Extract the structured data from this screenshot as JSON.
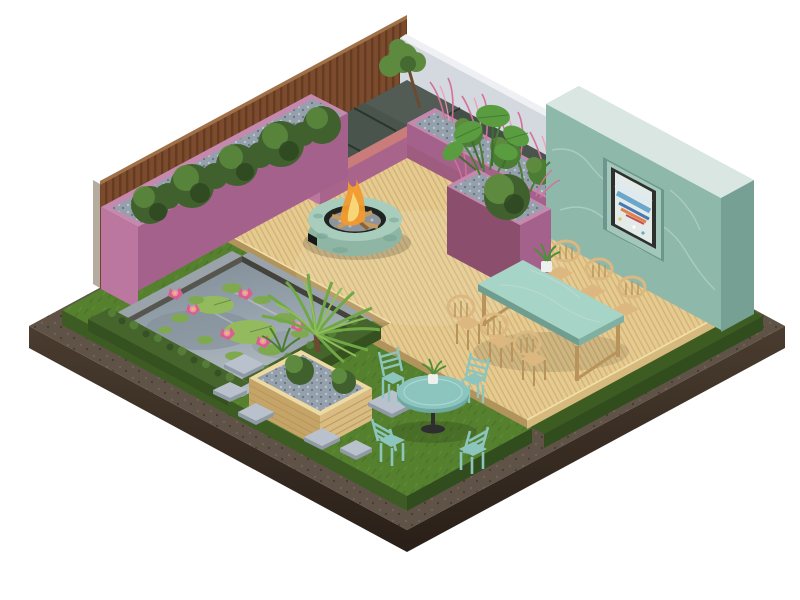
{
  "scene": {
    "title": "Isometric garden patio — 3D render",
    "width": 800,
    "height": 600,
    "background": "#ffffff"
  },
  "objects": [
    {
      "id": "timber-fence",
      "label": "Vertical timber slat fence"
    },
    {
      "id": "white-wall",
      "label": "White boundary wall"
    },
    {
      "id": "teal-marble-wall",
      "label": "Green marble feature wall with framed abstract painting"
    },
    {
      "id": "corner-bench",
      "label": "L-shaped bench with dark tiles and pink fascia"
    },
    {
      "id": "planter-long",
      "label": "Long pink planter with shrubs and gravel"
    },
    {
      "id": "planter-grasses",
      "label": "Back pink planter with pink fountain grasses"
    },
    {
      "id": "planter-tall",
      "label": "Tall pink planter with monstera, ferns and bush"
    },
    {
      "id": "deck",
      "label": "Timber slat deck patio"
    },
    {
      "id": "fire-pit",
      "label": "Round verdigris fire pit, lit with logs"
    },
    {
      "id": "pond",
      "label": "Reflecting pond with lily pads and pink water lilies"
    },
    {
      "id": "planter-timber",
      "label": "Timber slat planter with palm and bushes"
    },
    {
      "id": "dining-set",
      "label": "Green marble-top dining table with six timber chairs"
    },
    {
      "id": "bistro-set",
      "label": "Teal bistro table with four metal chairs on lawn"
    },
    {
      "id": "lawn",
      "label": "Lawn with stepping stones"
    },
    {
      "id": "soil-base",
      "label": "Dark soil base with gravel path border"
    }
  ],
  "palette": {
    "bg": "#ffffff",
    "soil_path": "#5f5347",
    "soil_speck_light": "#7b6b5c",
    "soil_speck_dark": "#382d23",
    "soil_side": "#4a3c2f",
    "soil_side_deep": "#291f18",
    "grass": "#55812f",
    "grass_light": "#69a03c",
    "grass_dark": "#3c5c22",
    "grass_side": "#3d5c23",
    "grass_side_dark": "#314d1e",
    "deck": "#e5cb90",
    "deck_line": "#c19b5e",
    "deck_side": "#d6b97c",
    "deck_side_dark": "#b1945c",
    "deck_lip": "#f2dfa8",
    "fence_wood": "#7c4a2c",
    "fence_line": "#5e3820",
    "fence_top": "#a07048",
    "fence_end": "#b5ac9f",
    "wall_white": "#d4d8df",
    "wall_white_top": "#eef0f4",
    "wall_teal": "#8db8aa",
    "wall_teal_top": "#d9e6e1",
    "wall_teal_side": "#abcfc2",
    "wall_teal_dark": "#76a093",
    "marble_vein": "#c6dcd3",
    "niche": "#6d978b",
    "niche_back": "#a3c8bb",
    "art_frame": "#2e302d",
    "art_bg": "#e3ebe9",
    "art_blue": "#6aa7cc",
    "art_blue_deep": "#4a76b4",
    "art_orange": "#e08348",
    "art_red": "#c44f58",
    "art_light": "#dfeaf0",
    "art_yellow": "#e8c455",
    "planter_pink": "#a4618b",
    "planter_pink_light": "#bb77a0",
    "planter_pink_dark": "#8c4e6d",
    "planter_pink_top": "#c489ad",
    "bench_tile": "#49544c",
    "bench_tile_gap": "#2b342e",
    "bench_pink": "#9e5d80",
    "bench_pink_side": "#a8648a",
    "bench_band": "#c17170",
    "bench_band_side": "#c97c79",
    "bench_end": "#b26a8e",
    "bench_end_light": "#bb77a0",
    "gravel": "#94a0ac",
    "gravel_light": "#bac3cd",
    "gravel_dark": "#66727f",
    "shrub": "#40612e",
    "shrub_light": "#5d8a3e",
    "shrub_dark": "#2d4520",
    "pink_grass": "#d4719a",
    "pink_grass_light": "#ef9ab8",
    "fern": "#4c7d35",
    "monstera": "#5a9c40",
    "monstera_dark": "#3f6e2e",
    "palm": "#6fa845",
    "palm_light": "#8fbe5a",
    "hedge": "#46652c",
    "hedge_side": "#35511f",
    "hedge_light": "#5d8a3e",
    "pond_water": "#96a2ab",
    "pond_light": "#b2bcc2",
    "pond_deep": "#7e8a94",
    "pond_wall_dark": "#44423d",
    "pond_wall": "#57554f",
    "lily_pad": "#7fa94e",
    "lily_pad_light": "#93bb5e",
    "lotus": "#d8618c",
    "lotus_light": "#ec93b0",
    "lotus_center": "#e8c455",
    "curb": "#9aa2aa",
    "stone": "#b9c2cc",
    "stone_side": "#8f9aa6",
    "fire_ring": "#a9cdbd",
    "fire_ring_side": "#8fb6a5",
    "fire_patina": "#6f9c8b",
    "fire_inner": "#20241f",
    "fire_base": "#171917",
    "pebble": "#8e949b",
    "pebble_light": "#babfc5",
    "log": "#c89a5c",
    "log_dark": "#8a6436",
    "flame": "#f29b2f",
    "flame_light": "#f8d678",
    "wood": "#dcb880",
    "wood_dark": "#b8935a",
    "wood_planter": "#d9bc82",
    "wood_planter_dark": "#c5a468",
    "wood_planter_top": "#eed9a2",
    "marble": "#a6d4c7",
    "marble_edge": "#7fb0a2",
    "marble_edge_dark": "#6f9e91",
    "metal_teal": "#8cc5bd",
    "metal_teal_dark": "#6da9a2",
    "metal_teal_light": "#a8d8d1",
    "pot": "#eef0ee",
    "plant": "#4e8f3a",
    "stem_black": "#2e2e2e",
    "trunk": "#6b4a32",
    "shadow": "#000000"
  }
}
